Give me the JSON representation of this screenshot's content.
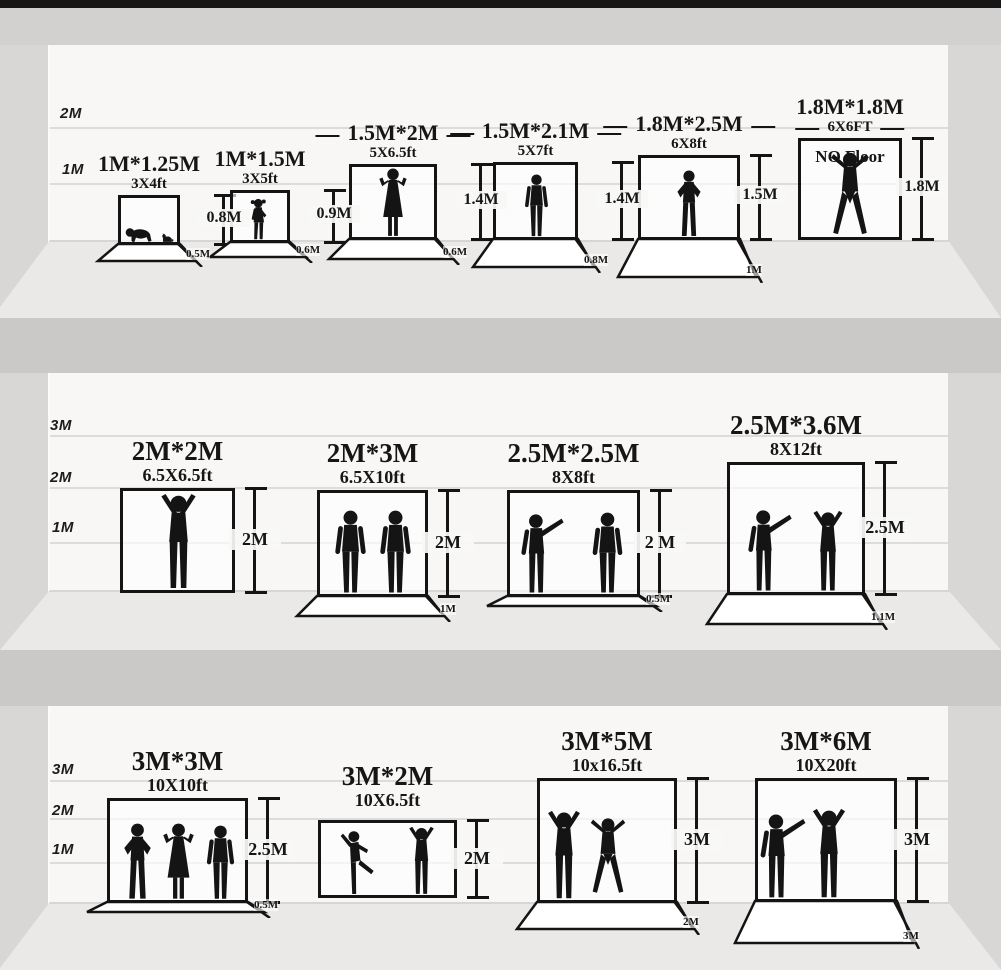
{
  "colors": {
    "ink": "#141414",
    "wall": "#f8f7f5",
    "floor": "#eae9e7",
    "separator": "#cbc9c8",
    "ceiling": "#d3d1cf",
    "top_bar": "#161616"
  },
  "bands": [
    {
      "axis": [
        "2M",
        "1M"
      ],
      "items": [
        {
          "size_m": "1M*1.25M",
          "size_ft": "3X4ft",
          "height": "0.8M",
          "floor": "0.5M",
          "figures": [
            "crawling-baby",
            "cat"
          ]
        },
        {
          "size_m": "1M*1.5M",
          "size_ft": "3X5ft",
          "height": "0.9M",
          "floor": "0.6M",
          "figures": [
            "toddler-girl"
          ]
        },
        {
          "size_m": "1.5M*2M",
          "size_ft": "5X6.5ft",
          "height": "1.4M",
          "floor": "0.6M",
          "figures": [
            "woman-arms-raised"
          ]
        },
        {
          "size_m": "1.5M*2.1M",
          "size_ft": "5X7ft",
          "height": "1.4M",
          "floor": "0.8M",
          "figures": [
            "man-standing"
          ]
        },
        {
          "size_m": "1.8M*2.5M",
          "size_ft": "6X8ft",
          "height": "1.5M",
          "floor": "1M",
          "figures": [
            "man-hands-on-hips"
          ]
        },
        {
          "size_m": "1.8M*1.8M",
          "size_ft": "6X6FT",
          "height": "1.8M",
          "note": "NO Floor",
          "figures": [
            "man-arms-spread"
          ]
        }
      ]
    },
    {
      "axis": [
        "3M",
        "2M",
        "1M"
      ],
      "items": [
        {
          "size_m": "2M*2M",
          "size_ft": "6.5X6.5ft",
          "height": "2M",
          "figures": [
            "man-cheering"
          ]
        },
        {
          "size_m": "2M*3M",
          "size_ft": "6.5X10ft",
          "height": "2M",
          "floor": "1M",
          "figures": [
            "two-men-standing"
          ]
        },
        {
          "size_m": "2.5M*2.5M",
          "size_ft": "8X8ft",
          "height": "2 M",
          "floor": "0.5M",
          "figures": [
            "two-people-talking"
          ]
        },
        {
          "size_m": "2.5M*3.6M",
          "size_ft": "8X12ft",
          "height": "2.5M",
          "floor": "1.1M",
          "figures": [
            "man-pointing",
            "man-with-camera"
          ]
        }
      ]
    },
    {
      "axis": [
        "3M",
        "2M",
        "1M"
      ],
      "items": [
        {
          "size_m": "3M*3M",
          "size_ft": "10X10ft",
          "height": "2.5M",
          "floor": "0.5M",
          "figures": [
            "three-people-group"
          ]
        },
        {
          "size_m": "3M*2M",
          "size_ft": "10X6.5ft",
          "height": "2M",
          "figures": [
            "two-dancers"
          ]
        },
        {
          "size_m": "3M*5M",
          "size_ft": "10x16.5ft",
          "height": "3M",
          "floor": "2M",
          "figures": [
            "three-dancers-arms-up"
          ]
        },
        {
          "size_m": "3M*6M",
          "size_ft": "10X20ft",
          "height": "3M",
          "floor": "3M",
          "figures": [
            "three-musicians"
          ]
        }
      ]
    }
  ]
}
